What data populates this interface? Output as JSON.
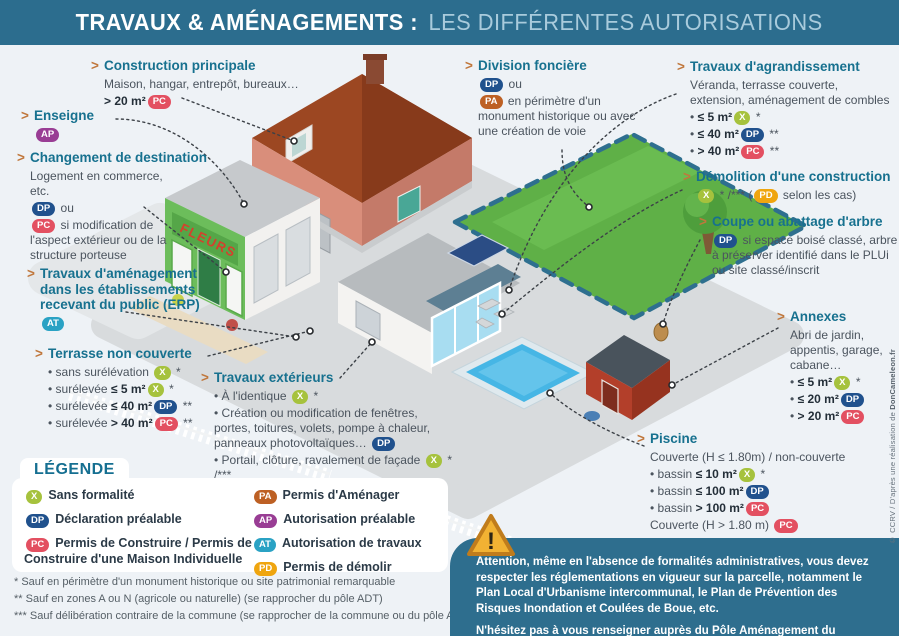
{
  "title": {
    "part1": "TRAVAUX & AMÉNAGEMENTS :",
    "part2": "LES DIFFÉRENTES AUTORISATIONS"
  },
  "marker": ">",
  "colors": {
    "titlebar": "#2c6d8e",
    "heading": "#17718f",
    "marker": "#c0773c",
    "background": "#eef2f6",
    "warning_box": "#2e6e8e"
  },
  "badges": {
    "X": {
      "label": "X",
      "color": "#a6c23d"
    },
    "DP": {
      "label": "DP",
      "color": "#20518d"
    },
    "PC": {
      "label": "PC",
      "color": "#e35061"
    },
    "PA": {
      "label": "PA",
      "color": "#bd6024"
    },
    "AP": {
      "label": "AP",
      "color": "#993d94"
    },
    "AT": {
      "label": "AT",
      "color": "#2aa2c4"
    },
    "PD": {
      "label": "PD",
      "color": "#efa50f"
    }
  },
  "callouts": [
    {
      "id": "construction-principale",
      "title": "Construction principale",
      "pos": {
        "left": 104,
        "top": 58,
        "width": 265
      },
      "lines": [
        [
          {
            "t": "text",
            "v": "Maison, hangar, entrepôt, bureaux…"
          }
        ],
        [
          {
            "t": "bold",
            "v": "> 20 m²"
          },
          {
            "t": "badge",
            "v": "PC"
          }
        ]
      ]
    },
    {
      "id": "enseigne",
      "title": "Enseigne",
      "pos": {
        "left": 34,
        "top": 108,
        "width": 90
      },
      "lines": [
        [
          {
            "t": "badge",
            "v": "AP"
          }
        ]
      ]
    },
    {
      "id": "changement-destination",
      "title": "Changement de destination",
      "pos": {
        "left": 30,
        "top": 150,
        "width": 192
      },
      "lines": [
        [
          {
            "t": "text",
            "v": "Logement en commerce, etc."
          }
        ],
        [
          {
            "t": "badge",
            "v": "DP"
          },
          {
            "t": "text",
            "v": " ou"
          }
        ],
        [
          {
            "t": "badge",
            "v": "PC"
          },
          {
            "t": "text",
            "v": " si modification de l'aspect extérieur ou de la structure porteuse"
          }
        ]
      ],
      "body_width": 140
    },
    {
      "id": "travaux-amenagement-erp",
      "title": "Travaux d'aménagement dans les établissements recevant du public (ERP)",
      "pos": {
        "left": 40,
        "top": 266,
        "width": 175
      },
      "lines": [
        [
          {
            "t": "badge",
            "v": "AT"
          }
        ]
      ]
    },
    {
      "id": "terrasse-non-couverte",
      "title": "Terrasse non couverte",
      "pos": {
        "left": 48,
        "top": 346,
        "width": 190
      },
      "lines": [
        [
          {
            "t": "text",
            "v": "• sans surélévation "
          },
          {
            "t": "badge",
            "v": "X"
          },
          {
            "t": "text",
            "v": " *"
          }
        ],
        [
          {
            "t": "text",
            "v": "• surélevée "
          },
          {
            "t": "bold",
            "v": "≤ 5 m²"
          },
          {
            "t": "badge",
            "v": "X"
          },
          {
            "t": "text",
            "v": " *"
          }
        ],
        [
          {
            "t": "text",
            "v": "• surélevée "
          },
          {
            "t": "bold",
            "v": "≤ 40 m²"
          },
          {
            "t": "badge",
            "v": "DP"
          },
          {
            "t": "text",
            "v": " **"
          }
        ],
        [
          {
            "t": "text",
            "v": "• surélevée "
          },
          {
            "t": "bold",
            "v": "> 40 m²"
          },
          {
            "t": "badge",
            "v": "PC"
          },
          {
            "t": "text",
            "v": " **"
          }
        ]
      ]
    },
    {
      "id": "travaux-exterieurs",
      "title": "Travaux extérieurs",
      "pos": {
        "left": 214,
        "top": 370,
        "width": 238
      },
      "lines": [
        [
          {
            "t": "text",
            "v": "• À l'identique "
          },
          {
            "t": "badge",
            "v": "X"
          },
          {
            "t": "text",
            "v": " *"
          }
        ],
        [
          {
            "t": "text",
            "v": "• Création ou modification de fenêtres, portes, toitures, volets, pompe à chaleur, panneaux photovoltaïques… "
          },
          {
            "t": "badge",
            "v": "DP"
          }
        ],
        [
          {
            "t": "text",
            "v": "• Portail, clôture, ravalement de façade "
          },
          {
            "t": "badge",
            "v": "X"
          },
          {
            "t": "text",
            "v": " * /***"
          }
        ]
      ]
    },
    {
      "id": "division-fonciere",
      "title": "Division foncière",
      "pos": {
        "left": 478,
        "top": 58,
        "width": 158
      },
      "lines": [
        [
          {
            "t": "badge",
            "v": "DP"
          },
          {
            "t": "text",
            "v": " ou"
          }
        ],
        [
          {
            "t": "badge",
            "v": "PA"
          },
          {
            "t": "text",
            "v": " en périmètre d'un monument historique ou avec une création de voie"
          }
        ]
      ]
    },
    {
      "id": "travaux-agrandissement",
      "title": "Travaux d'agrandissement",
      "pos": {
        "left": 690,
        "top": 59,
        "width": 205
      },
      "lines": [
        [
          {
            "t": "text",
            "v": "Véranda, terrasse couverte, extension, aménagement de combles"
          }
        ],
        [
          {
            "t": "text",
            "v": "• "
          },
          {
            "t": "bold",
            "v": "≤ 5 m²"
          },
          {
            "t": "badge",
            "v": "X"
          },
          {
            "t": "text",
            "v": " *"
          }
        ],
        [
          {
            "t": "text",
            "v": "• "
          },
          {
            "t": "bold",
            "v": "≤ 40 m²"
          },
          {
            "t": "badge",
            "v": "DP"
          },
          {
            "t": "text",
            "v": " **"
          }
        ],
        [
          {
            "t": "text",
            "v": "• "
          },
          {
            "t": "bold",
            "v": "> 40 m²"
          },
          {
            "t": "badge",
            "v": "PC"
          },
          {
            "t": "text",
            "v": " **"
          }
        ]
      ]
    },
    {
      "id": "demolition-construction",
      "title": "Démolition d'une construction",
      "pos": {
        "left": 696,
        "top": 169,
        "width": 200
      },
      "lines": [
        [
          {
            "t": "badge",
            "v": "X"
          },
          {
            "t": "text",
            "v": " * /*** ("
          },
          {
            "t": "badge",
            "v": "PD"
          },
          {
            "t": "text",
            "v": " selon les cas)"
          }
        ]
      ]
    },
    {
      "id": "coupe-abattage-arbre",
      "title": "Coupe ou abattage d'arbre",
      "pos": {
        "left": 712,
        "top": 214,
        "width": 186
      },
      "lines": [
        [
          {
            "t": "badge",
            "v": "DP"
          },
          {
            "t": "text",
            "v": " si espace boisé classé, arbre à préserver identifié dans le PLUi ou site classé/inscrit"
          }
        ]
      ]
    },
    {
      "id": "annexes",
      "title": "Annexes",
      "pos": {
        "left": 790,
        "top": 309,
        "width": 104
      },
      "lines": [
        [
          {
            "t": "text",
            "v": "Abri de jardin, appentis, garage, cabane…"
          }
        ],
        [
          {
            "t": "text",
            "v": "• "
          },
          {
            "t": "bold",
            "v": "≤ 5 m²"
          },
          {
            "t": "badge",
            "v": "X"
          },
          {
            "t": "text",
            "v": " *"
          }
        ],
        [
          {
            "t": "text",
            "v": "• "
          },
          {
            "t": "bold",
            "v": "≤ 20 m²"
          },
          {
            "t": "badge",
            "v": "DP"
          }
        ],
        [
          {
            "t": "text",
            "v": "• "
          },
          {
            "t": "bold",
            "v": "> 20 m²"
          },
          {
            "t": "badge",
            "v": "PC"
          }
        ]
      ]
    },
    {
      "id": "piscine",
      "title": "Piscine",
      "pos": {
        "left": 650,
        "top": 431,
        "width": 232
      },
      "lines": [
        [
          {
            "t": "text",
            "v": "Couverte (H ≤ 1.80m) / non-couverte"
          }
        ],
        [
          {
            "t": "text",
            "v": "• bassin "
          },
          {
            "t": "bold",
            "v": "≤ 10 m²"
          },
          {
            "t": "badge",
            "v": "X"
          },
          {
            "t": "text",
            "v": " *"
          }
        ],
        [
          {
            "t": "text",
            "v": "• bassin "
          },
          {
            "t": "bold",
            "v": "≤ 100 m²"
          },
          {
            "t": "badge",
            "v": "DP"
          }
        ],
        [
          {
            "t": "text",
            "v": "• bassin "
          },
          {
            "t": "bold",
            "v": "> 100 m²"
          },
          {
            "t": "badge",
            "v": "PC"
          }
        ],
        [
          {
            "t": "text",
            "v": "Couverte (H > 1.80 m) "
          },
          {
            "t": "badge",
            "v": "PC"
          }
        ]
      ]
    }
  ],
  "legend": {
    "title": "LÉGENDE",
    "col1": [
      {
        "badge": "X",
        "label": "Sans formalité"
      },
      {
        "badge": "DP",
        "label": "Déclaration préalable"
      },
      {
        "badge": "PC",
        "label": "Permis de Construire / Permis de Construire d'une Maison Individuelle"
      }
    ],
    "col2": [
      {
        "badge": "PA",
        "label": "Permis d'Aménager"
      },
      {
        "badge": "AP",
        "label": "Autorisation préalable"
      },
      {
        "badge": "AT",
        "label": "Autorisation de travaux"
      },
      {
        "badge": "PD",
        "label": "Permis de démolir"
      }
    ]
  },
  "footnotes": [
    "* Sauf en périmètre d'un monument historique ou site patrimonial remarquable",
    "** Sauf en zones A ou N (agricole ou naturelle) (se rapprocher du pôle ADT)",
    "*** Sauf délibération contraire de la commune (se rapprocher de la commune ou du pôle ADT)"
  ],
  "warning": {
    "p1": "Attention, même en l'absence de formalités administratives, vous devez respecter les réglementations en vigueur sur la parcelle, notamment le Plan Local d'Urbanisme intercommunal, le Plan de Prévention des Risques Inondation et Coulées de Boue, etc.",
    "p2": "N'hésitez pas à vous renseigner auprès du Pôle Aménagement du Territoire !"
  },
  "credit": {
    "prefix": "© CCRV / D'après une réalisation de ",
    "brand": "DonCameleon.fr"
  },
  "illustration_labels": {
    "shop_sign": "FLEURS"
  }
}
